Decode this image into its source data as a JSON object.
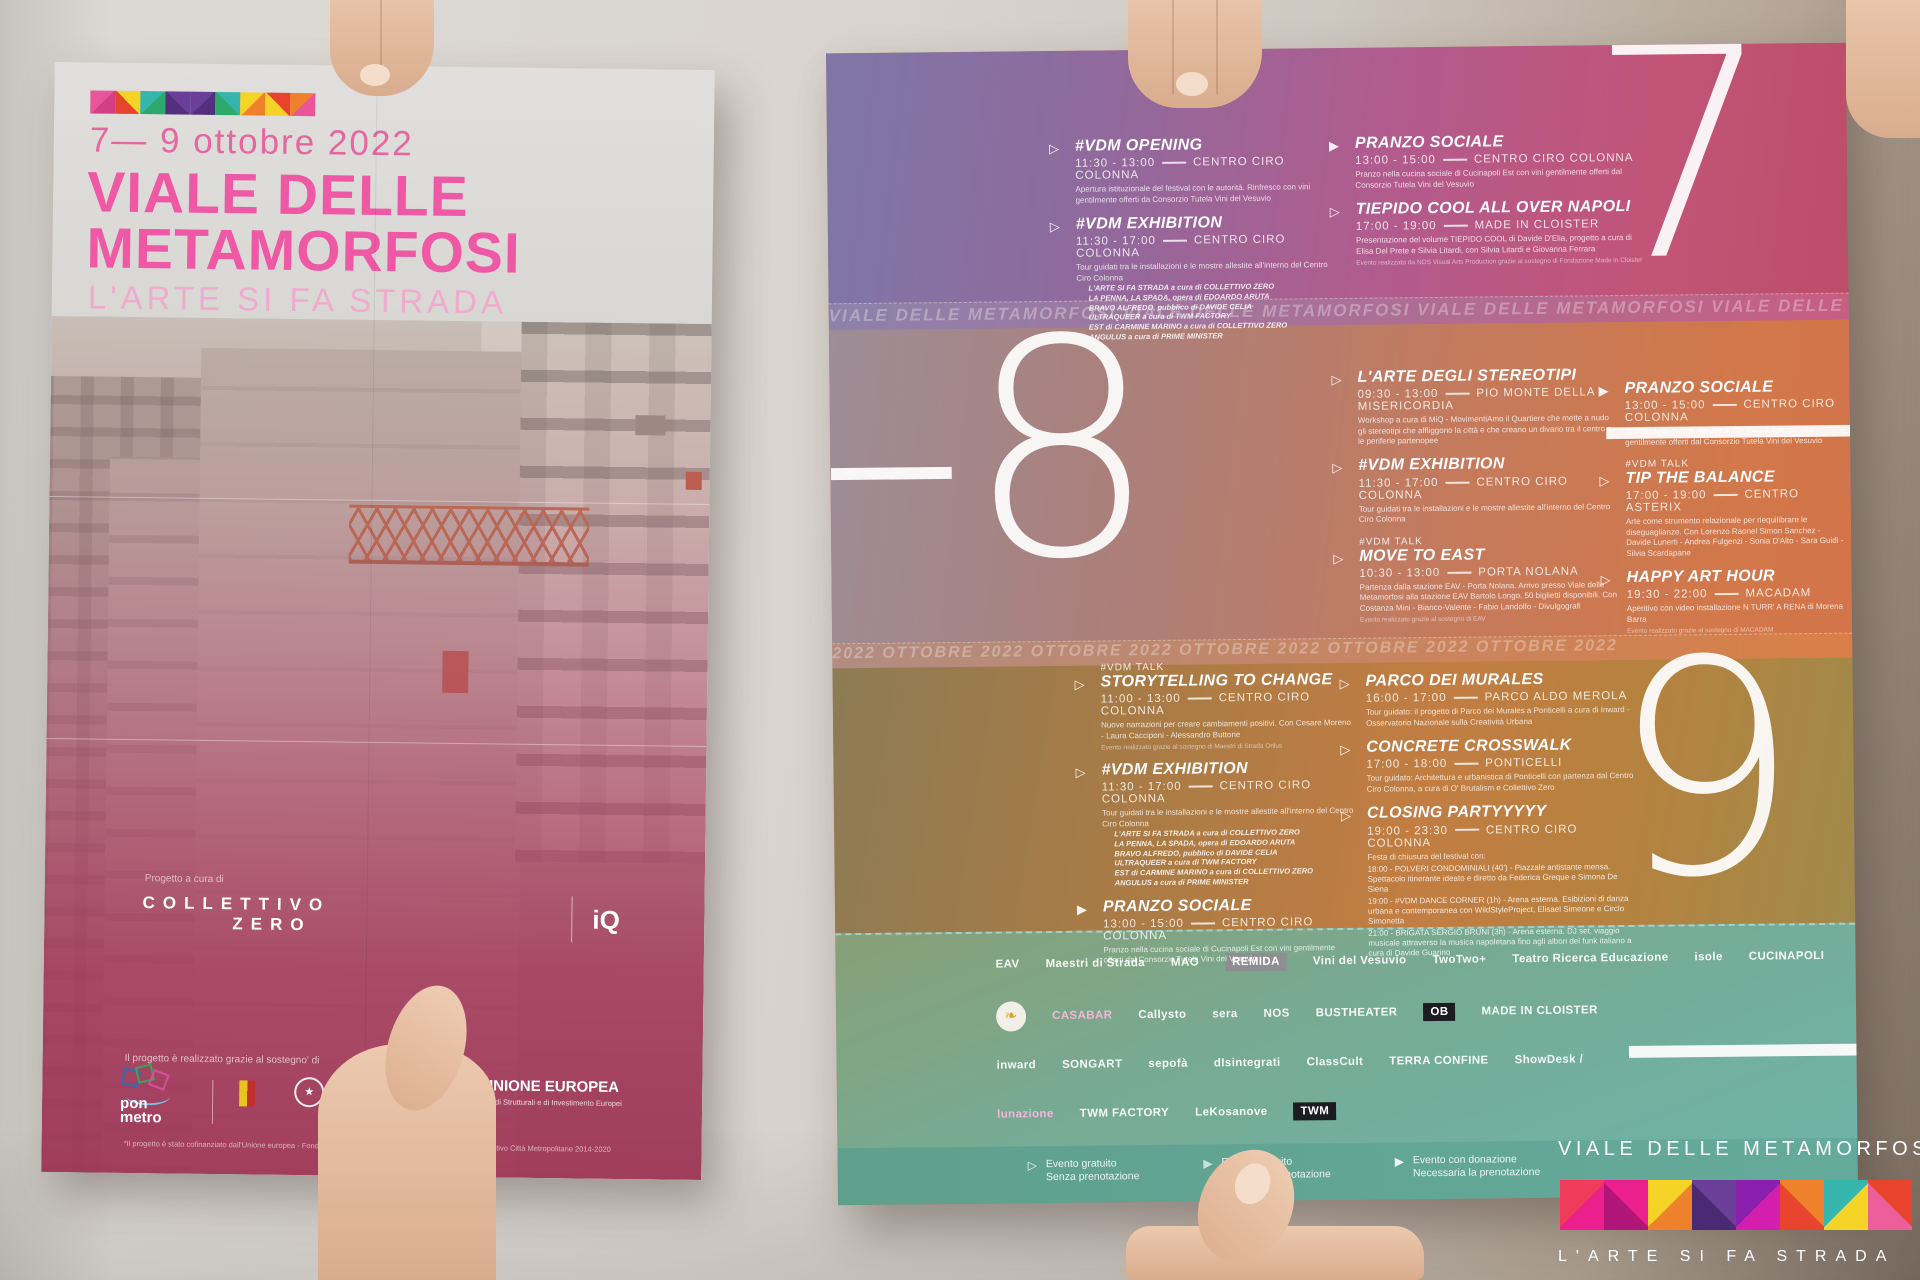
{
  "colors": {
    "brand_pink": "#ee58a4",
    "light_pink": "#f0abcc",
    "day7_purple": "#7e77a7",
    "day7_magenta": "#bc4e6a",
    "day8_orange": "#d2784a",
    "day9_olive": "#8d7b55",
    "sponsor_teal": "#6fb3a7",
    "eu_blue": "#24418e",
    "white": "#ffffff"
  },
  "front": {
    "date": "7— 9 ottobre 2022",
    "title1": "VIALE DELLE",
    "title2": "METAMORFOSI",
    "subtitle": "L'ARTE SI FA STRADA",
    "credit": "Progetto a cura di",
    "curator1": "COLLETTIVO",
    "curator2": "ZERO",
    "iq": "iQ",
    "support": "Il progetto è realizzato grazie al sostegno' di",
    "ponmetro1": "pon",
    "ponmetro2": "metro",
    "emblem_star": "★",
    "eu_name": "UNIONE EUROPEA",
    "eu_sub": "Fondi Strutturali e di Investimento Europei",
    "funding": "*Il progetto è stato cofinanziato dall'Unione europea - Fondo Sociale Europeo, nell'ambito del Programma Operativo Città Metropolitane 2014-2020"
  },
  "back": {
    "numeral7": "7—",
    "numeral8": "–8",
    "numeral9": "9—",
    "fold1": "VIALE DELLE METAMORFOSI VIALE DELLE METAMORFOSI VIALE DELLE METAMORFOSI VIALE DELLE METAMORFOSI",
    "fold2": "2022 OTTOBRE 2022 OTTOBRE 2022 OTTOBRE 2022 OTTOBRE 2022 OTTOBRE 2022",
    "exhibition_works": [
      "L'ARTE SI FA STRADA a cura di COLLETTIVO ZERO",
      "LA PENNA, LA SPADA, opera di EDOARDO ARUTA",
      "BRAVO ALFREDO, pubblico di DAVIDE CELIA",
      "ULTRAQUEER a cura di TWM FACTORY",
      "EST di CARMINE MARINO a cura di COLLETTIVO ZERO",
      "ANGULUS a cura di PRIME MINISTER"
    ],
    "events": {
      "opening": {
        "title": "#VDM  OPENING",
        "time": "11:30 - 13:00",
        "venue": "CENTRO CIRO COLONNA",
        "desc": "Apertura istituzionale del festival con le autorità. Rinfresco con vini gentilmente offerti da Consorzio Tutela Vini del Vesuvio"
      },
      "exhibition": {
        "title": "#VDM EXHIBITION",
        "time": "11:30 - 17:00",
        "venue": "CENTRO CIRO COLONNA",
        "desc": "Tour guidati tra le installazioni e le mostre allestite all'interno del Centro Ciro Colonna"
      },
      "pranzo": {
        "title": "PRANZO SOCIALE",
        "time": "13:00 - 15:00",
        "venue": "CENTRO CIRO COLONNA",
        "desc": "Pranzo nella cucina sociale di Cucinapoli Est con vini gentilmente offerti dal Consorzio Tutela Vini del Vesuvio"
      },
      "tiepido": {
        "title": "TIEPIDO COOL ALL OVER NAPOLI",
        "time": "17:00 - 19:00",
        "venue": "MADE IN CLOISTER",
        "desc": "Presentazione del volume TIEPIDO COOL di Davide D'Elia, progetto a cura di Elisa Del Prete e Silvia Litardi, con Silvia Litardi e Giovanna Ferrara",
        "note": "Evento realizzato da NOS Visual Arts Production grazie al sostegno di Fondazione Made in Cloister"
      },
      "stereotipi": {
        "title": "L'ARTE DEGLI STEREOTIPI",
        "time": "09:30 - 13:00",
        "venue": "PIO MONTE DELLA MISERICORDIA",
        "desc": "Workshop a cura di MiQ - MovimentiAmo il Quartiere che mette a nudo gli stereotipi che affliggono la città e che creano un divario tra il centro e le periferie partenopee"
      },
      "move": {
        "tag": "#VDM TALK",
        "title": "MOVE TO EAST",
        "time": "10:30 - 13:00",
        "venue": "PORTA NOLANA",
        "desc": "Partenza dalla stazione EAV - Porta Nolana. Arrivo presso Viale delle Metamorfosi alla stazione EAV Bartolo Longo. 50 biglietti disponibili. Con Costanza Mini - Bianco-Valente - Fabio Landolfo - Divulgografi",
        "note": "Evento realizzato grazie al sostegno di EAV"
      },
      "tip": {
        "tag": "#VDM TALK",
        "title": "TIP THE BALANCE",
        "time": "17:00 - 19:00",
        "venue": "CENTRO ASTERIX",
        "desc": "Arte come strumento relazionale per riequilibrare le diseguaglianze. Con Lorenzo Raonel Simon Sanchez - Davide Lunerti - Andrea Fulgenzi - Sonia D'Alto - Sara Guidi - Silvia Scardapane"
      },
      "happy": {
        "title": "HAPPY ART HOUR",
        "time": "19:30 - 22:00",
        "venue": "MACADAM",
        "desc": "Aperitivo con video installazione N TURR' A RENA di Morena Barra",
        "note": "Evento realizzato grazie al sostegno di MACADAM"
      },
      "storytelling": {
        "tag": "#VDM TALK",
        "title": "STORYTELLING TO CHANGE",
        "time": "11:00 - 13:00",
        "venue": "CENTRO CIRO COLONNA",
        "desc": "Nuove narrazioni per creare cambiamenti positivi. Con Cesare Moreno - Laura Cacciponi - Alessandro Buttone",
        "note": "Evento realizzato grazie al sostegno di Maestri di Strada Onlus"
      },
      "parco": {
        "title": "PARCO DEI MURALES",
        "time": "16:00 - 17:00",
        "venue": "PARCO ALDO MEROLA",
        "desc": "Tour guidato: il progetto di Parco dei Murales a Ponticelli a cura di Inward - Osservatorio Nazionale sulla Creatività Urbana"
      },
      "concrete": {
        "title": "CONCRETE CROSSWALK",
        "time": "17:00 - 18:00",
        "venue": "PONTICELLI",
        "desc": "Tour guidato: Architettura e urbanistica di Ponticelli con partenza dal Centro Ciro Colonna, a cura di O' Brutalism e Collettivo Zero"
      },
      "closing": {
        "title": "CLOSING PARTYYYYY",
        "time": "19:00 - 23:30",
        "venue": "CENTRO CIRO COLONNA",
        "desc": "Festa di chiusura del festival con:",
        "schedule": [
          "18:00 - POLVERI CONDOMINIALI (40') - Piazzale antistante mensa. Spettacolo itinerante ideato e diretto da Federica Greque e Simona De Siena",
          "19:00 - #VDM DANCE CORNER (1h) - Arena esterna. Esibizioni di danza urbana e contemporanea con WildStyleProject, Elisael Simeone e Circlo Simonetta",
          "21:00 - BRIGATA SERGIO BRUNI (3h) - Arena esterna. DJ set, viaggio musicale attraverso la musica napoletana fino agli albori del funk italiano a cura di Davide Guarino"
        ]
      }
    },
    "sponsors": {
      "r1": [
        "EAV",
        "Maestri di Strada",
        "MAO",
        "REMIDA",
        "Vini del Vesuvio",
        "TwoTwo+",
        "Teatro Ricerca Educazione",
        "isole",
        "CUCINAPOLI"
      ],
      "r2": [
        "CASABAR",
        "Callysto",
        "sera",
        "NOS",
        "BUSTHEATER",
        "OB",
        "MADE IN CLOISTER"
      ],
      "r3": [
        "inward",
        "SONGART",
        "sepofà",
        "dIsintegrati",
        "ClassCult",
        "TERRA CONFINE",
        "ShowDesk /"
      ],
      "r4": [
        "lunazione",
        "TWM FACTORY",
        "LeKosanove",
        "TWM"
      ],
      "gingko": "❧"
    },
    "legend": [
      {
        "l1": "Evento gratuito",
        "l2": "Senza prenotazione"
      },
      {
        "l1": "Evento gratuito",
        "l2": "Gradita la prenotazione"
      },
      {
        "l1": "Evento con donazione",
        "l2": "Necessaria la prenotazione"
      }
    ]
  },
  "overlay": {
    "title": "VIALE DELLE METAMORFOSI",
    "subtitle": "L'ARTE SI FA STRADA"
  }
}
